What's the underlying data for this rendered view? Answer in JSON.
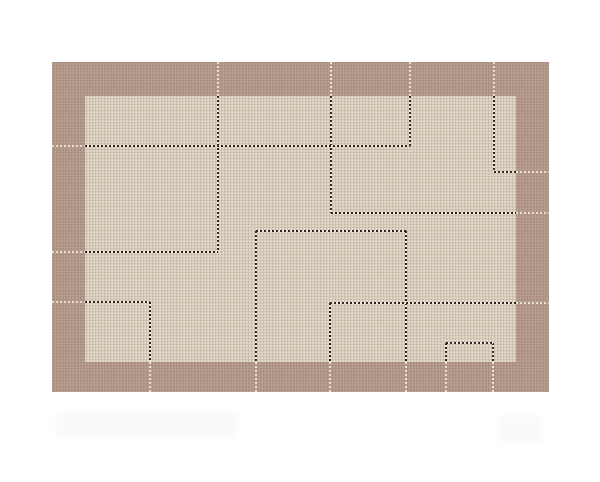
{
  "canvas": {
    "width": 600,
    "height": 482,
    "background": "#ffffff"
  },
  "rug": {
    "x": 52,
    "y": 62,
    "width": 497,
    "height": 330,
    "border_color": "#b29686",
    "field": {
      "x": 85,
      "y": 96,
      "width": 431,
      "height": 266,
      "color": "#ddd0be"
    },
    "stitch_color": "#262019",
    "stitch_gap_color": "#f1eadd",
    "accent_color": "rgba(255,252,245,0.75)",
    "pattern": {
      "stitch_vertical": [
        {
          "x": 218,
          "y1": 96,
          "y2": 252
        },
        {
          "x": 331,
          "y1": 96,
          "y2": 213
        },
        {
          "x": 410,
          "y1": 96,
          "y2": 146
        },
        {
          "x": 494,
          "y1": 96,
          "y2": 172
        },
        {
          "x": 256,
          "y1": 231,
          "y2": 362
        },
        {
          "x": 406,
          "y1": 231,
          "y2": 362
        },
        {
          "x": 150,
          "y1": 302,
          "y2": 362
        },
        {
          "x": 330,
          "y1": 303,
          "y2": 362
        },
        {
          "x": 446,
          "y1": 343,
          "y2": 362
        },
        {
          "x": 493,
          "y1": 343,
          "y2": 362
        }
      ],
      "stitch_horizontal": [
        {
          "y": 146,
          "x1": 85,
          "x2": 410
        },
        {
          "y": 172,
          "x1": 494,
          "x2": 516
        },
        {
          "y": 213,
          "x1": 331,
          "x2": 516
        },
        {
          "y": 231,
          "x1": 256,
          "x2": 406
        },
        {
          "y": 252,
          "x1": 85,
          "x2": 218
        },
        {
          "y": 302,
          "x1": 85,
          "x2": 150
        },
        {
          "y": 303,
          "x1": 330,
          "x2": 516
        },
        {
          "y": 343,
          "x1": 446,
          "x2": 493
        }
      ],
      "accent_top_x": [
        218,
        331,
        410,
        494
      ],
      "accent_bottom_x": [
        150,
        256,
        330,
        406,
        446,
        493
      ],
      "accent_left_y": [
        146,
        252,
        302
      ],
      "accent_right_y": [
        172,
        213,
        303
      ]
    }
  },
  "watermark": {
    "legible": false,
    "blobs": [
      {
        "x": 56,
        "y": 411,
        "w": 182,
        "h": 28
      },
      {
        "x": 498,
        "y": 415,
        "w": 44,
        "h": 28
      }
    ]
  }
}
